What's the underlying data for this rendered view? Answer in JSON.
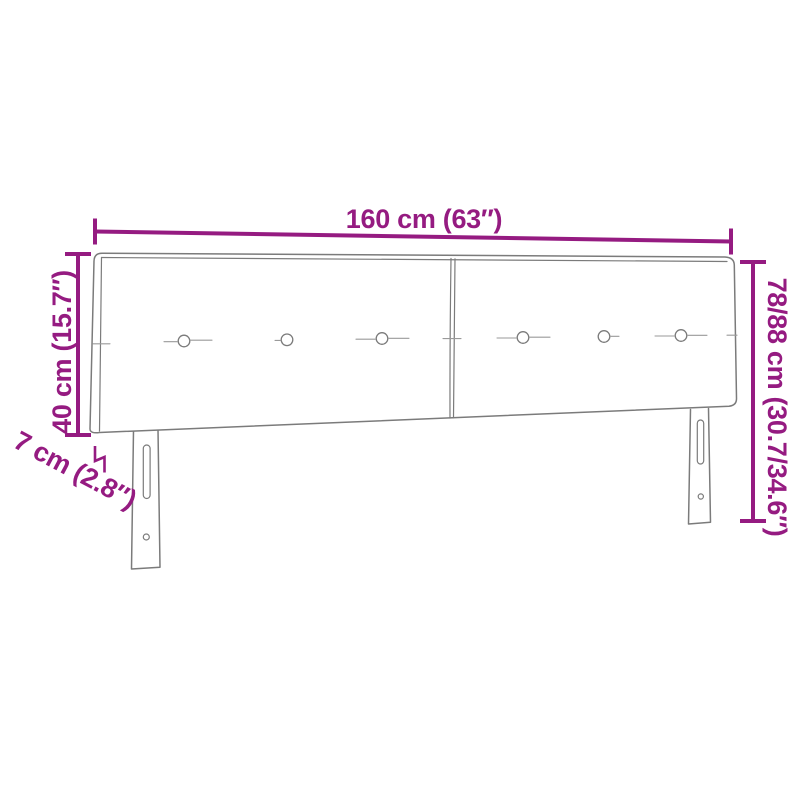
{
  "diagram": {
    "type": "product-dimension-diagram",
    "subject": "two-panel upholstered headboard with tufting buttons and two slotted legs",
    "background_color": "#ffffff",
    "outline_color": "#7b7b7b",
    "crease_color": "#9a9a9a",
    "dimension_color": "#951b81",
    "labels": {
      "width": "160 cm (63″)",
      "panel_height": "40 cm (15.7″)",
      "total_height": "78/88 cm (30.7/34.6″)",
      "depth": "7 cm (2.8″)"
    },
    "button_count": 6
  }
}
